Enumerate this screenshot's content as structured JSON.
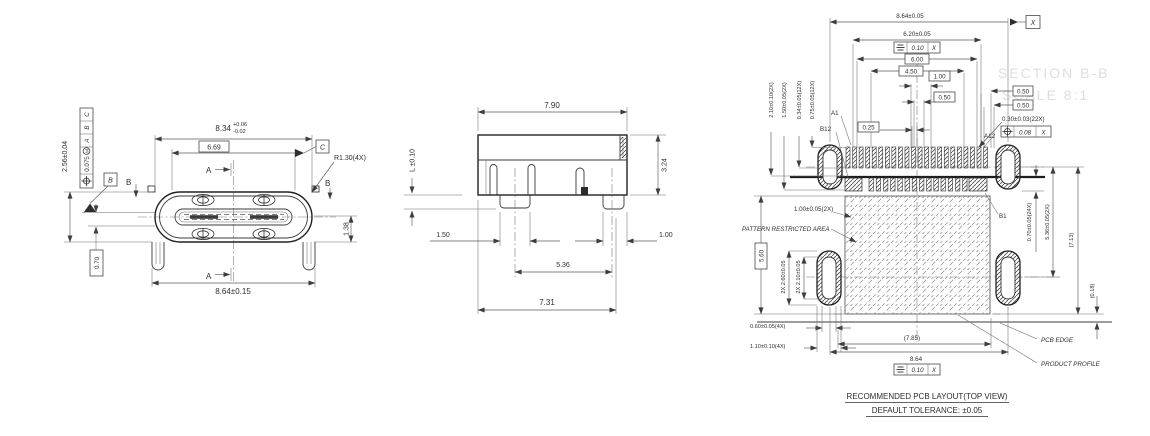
{
  "front": {
    "dim_width": "8.34",
    "dim_width_tol_up": "+0.06",
    "dim_width_tol_dn": "-0.02",
    "dim_tongue": "6.69",
    "corner_radius": "R1.30(4X)",
    "dim_height": "2.56±0.04",
    "fcf_value": "0.075",
    "fcf_mod": "M",
    "fcf_datum_1": "A",
    "fcf_datum_2": "B",
    "fcf_datum_3": "C",
    "datum_b": "B",
    "datum_c": "C",
    "section_b": "B",
    "section_a": "A",
    "dim_tongue_offset": "1.38",
    "dim_wall": "0.70",
    "dim_span": "8.64±0.15"
  },
  "side": {
    "dim_width": "7.90",
    "dim_standoff": "L ±0.10",
    "dim_height": "3.24",
    "dim_leg_left": "1.50",
    "dim_leg_right": "1.00",
    "dim_leg_span": "5.36",
    "dim_body": "7.31"
  },
  "pcb": {
    "dim_slot_span": "8.64±0.05",
    "datum_x": "X",
    "dim_620": "6.20±0.05",
    "fcf_sym_tol": "0.10",
    "fcf_sym_datum": "X",
    "dim_600": "6.00",
    "dim_450": "4.50",
    "dim_100": "1.00",
    "dim_050_a": "0.50",
    "dim_050_b": "0.50",
    "dim_050_c": "0.50",
    "dim_025": "0.25",
    "dim_pad_width": "0.30±0.03(22X)",
    "fcf_pos_tol": "0.08",
    "fcf_pos_datum": "X",
    "pin_a1": "A1",
    "pin_b12": "B12",
    "pin_a12": "A12",
    "pin_b1": "B1",
    "dim_v1": "2.10±0.10(2X)",
    "dim_v2": "1.50±0.05(2X)",
    "dim_v3": "0.34±0.05(12X)",
    "dim_v4": "0.75±0.05(12X)",
    "dim_100_2x": "1.00±0.05(2X)",
    "restricted_label": "PATTERN RESTRICTED AREA",
    "dim_560": "5.60",
    "dim_260": "2X 2.60±0.05",
    "dim_210": "2X 2.10±0.05",
    "dim_060": "0.60±0.05(4X)",
    "dim_110": "1.10±0.10(4X)",
    "dim_785": "(7.85)",
    "dim_864": "8.64",
    "fcf_bot_tol": "0.10",
    "fcf_bot_datum": "X",
    "dim_pad_len": "0.70±0.05(24X)",
    "dim_row_span": "5.36±0.05(2X)",
    "dim_713": "(7.13)",
    "dim_018": "(0.18)",
    "pcb_edge": "PCB EDGE",
    "product_profile": "PRODUCT PROFILE",
    "title": "RECOMMENDED PCB LAYOUT(TOP VIEW)",
    "tolerance_note": "DEFAULT TOLERANCE: ±0.05",
    "ghost_1": "SECTION B-B",
    "ghost_2": "SCALE 8:1"
  }
}
